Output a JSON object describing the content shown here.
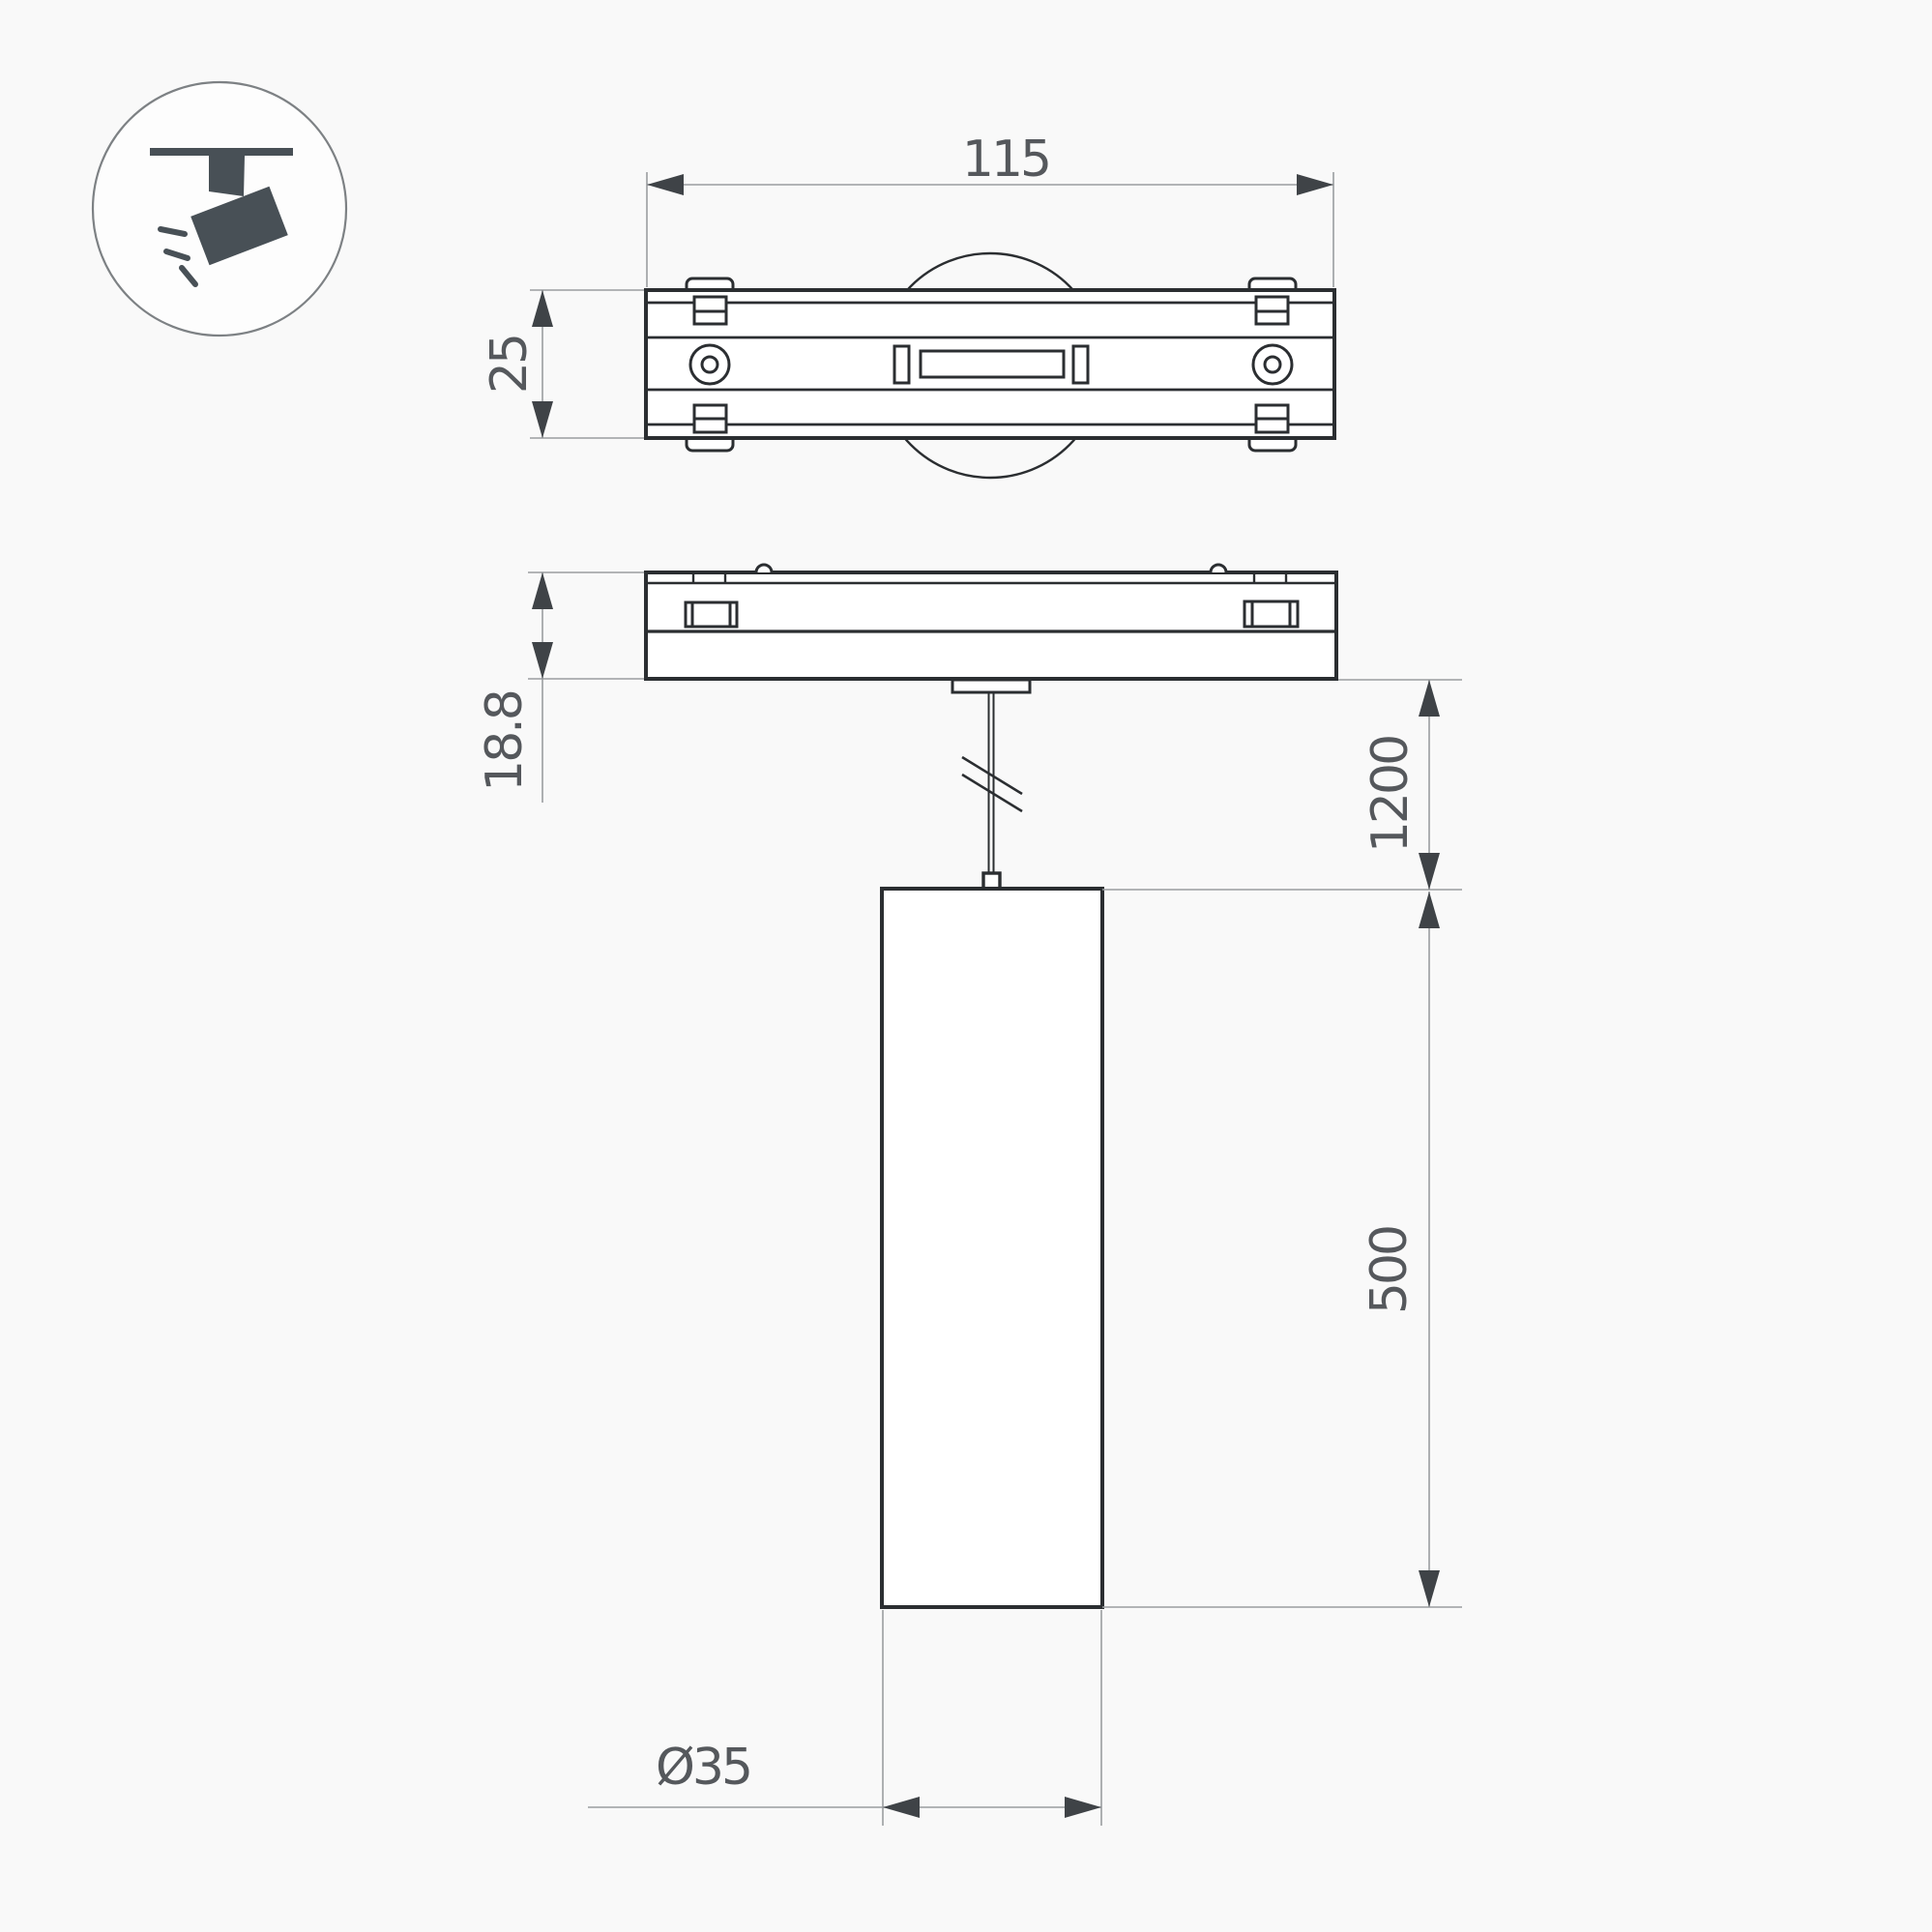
{
  "title": "Pendant track luminaire dimensional drawing",
  "icon": {
    "name": "track-spotlight",
    "color": "#485056",
    "circle_stroke": "#7d8184"
  },
  "colors": {
    "background": "#f9f9f9",
    "line": "#2b2e31",
    "thin_line": "#9a9da0",
    "arrow": "#3f4347",
    "text": "#55585c"
  },
  "dimensions": {
    "adapter_length": "115",
    "adapter_width": "25",
    "adapter_height": "18.8",
    "suspension_length": "1200",
    "body_height": "500",
    "body_diameter": "Ø35"
  }
}
